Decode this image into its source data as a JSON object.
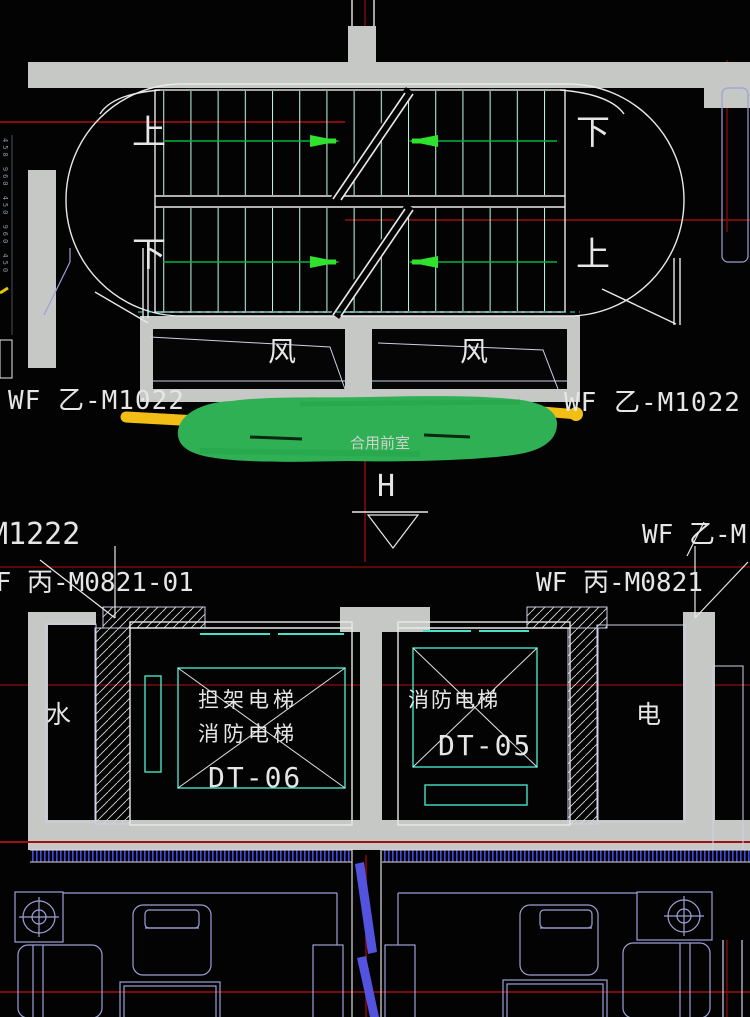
{
  "stair": {
    "up_left": "上",
    "down_right": "下",
    "down_left": "下",
    "up_right": "上"
  },
  "vents": {
    "left": "风",
    "right": "风"
  },
  "door_tags": {
    "top_left": "WF 乙-M1022",
    "top_right": "WF 乙-M1022",
    "mid_left": "M1222",
    "mid_right": "WF 乙-M",
    "lower_left": "WF 丙-M0821-01",
    "lower_right": "WF 丙-M0821"
  },
  "lobby": {
    "name": "合用前室",
    "marker": "H"
  },
  "rooms": {
    "water": "水",
    "electric": "电"
  },
  "elevators": {
    "dt06": {
      "line1": "担架电梯",
      "line2": "消防电梯",
      "tag": "DT-06"
    },
    "dt05": {
      "line1": "消防电梯",
      "tag": "DT-05"
    }
  },
  "dimensions": {
    "left_edge": "450 960 450 960 450"
  },
  "colors": {
    "background": "#030303",
    "wall_gray": "#c6c8c5",
    "line_white": "#e9e9e9",
    "stair_tread_cyan": "#b9efe4",
    "cad_cyan": "#49e0c8",
    "grid_red": "#b01010",
    "grid_red_dim": "#7a0a0a",
    "arrow_green": "#2ee22e",
    "flight_line_green": "#00b43c",
    "furniture_lavender": "#9e9ed6",
    "hatch_blue": "#4646d8",
    "highlight_green": "#2fb054",
    "highlight_yellow": "#f2be16"
  }
}
